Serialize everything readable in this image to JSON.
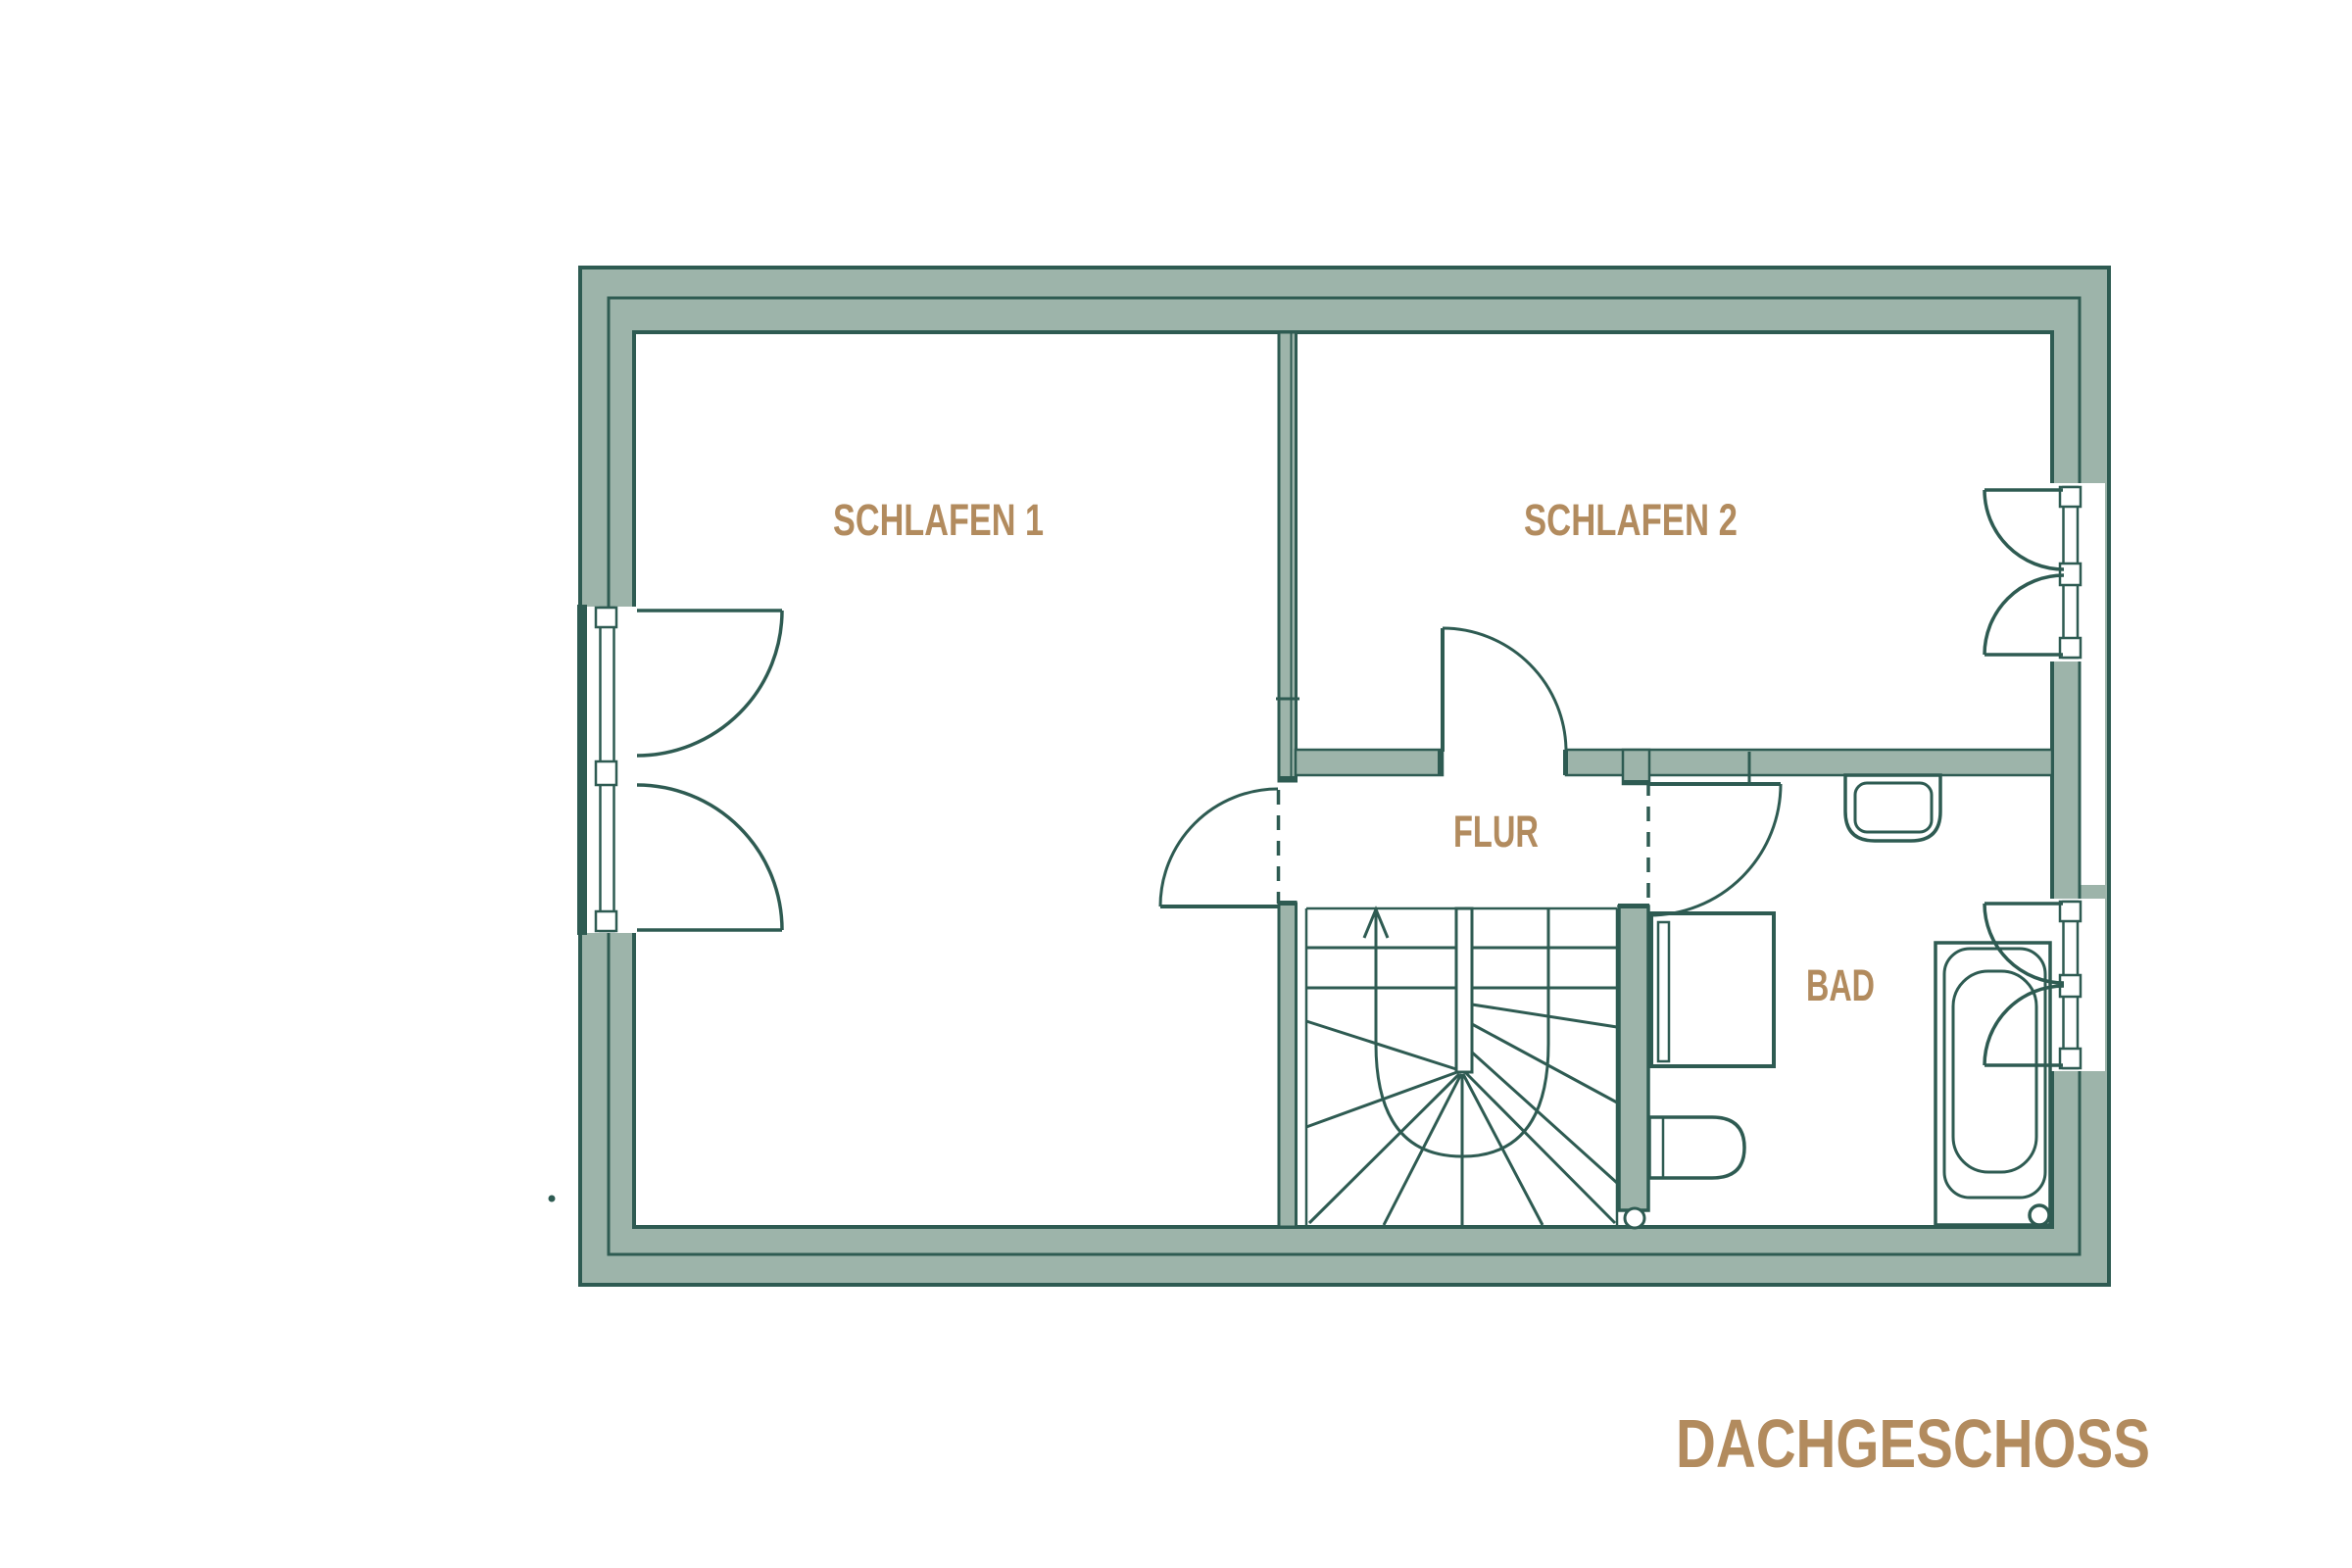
{
  "title": "DACHGESCHOSS",
  "floor_plan": {
    "rooms": [
      {
        "id": "schlafen1",
        "label": "SCHLAFEN 1"
      },
      {
        "id": "schlafen2",
        "label": "SCHLAFEN 2"
      },
      {
        "id": "flur",
        "label": "FLUR"
      },
      {
        "id": "bad",
        "label": "BAD"
      }
    ]
  },
  "colors": {
    "wall_fill": "#9DB4AA",
    "wall_line": "#2E5B52",
    "label": "#B28B5E",
    "background": "#FFFFFF"
  }
}
